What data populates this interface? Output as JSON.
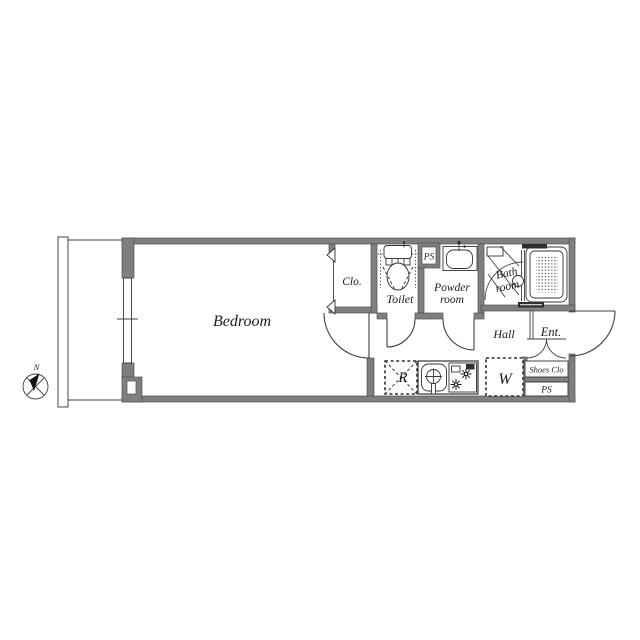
{
  "document": {
    "type": "apartment-floor-plan"
  },
  "colors": {
    "wall": "#7f7f7f",
    "line": "#3f3f3f",
    "text": "#1c1c1c",
    "background": "#ffffff"
  },
  "compass": {
    "north_label": "N"
  },
  "rooms": {
    "bedroom": {
      "label": "Bedroom"
    },
    "closet": {
      "label": "Clo."
    },
    "toilet": {
      "label": "Toilet"
    },
    "ps_top": {
      "label": "PS"
    },
    "powder": {
      "line1": "Powder",
      "line2": "room"
    },
    "bath": {
      "line1": "Bath",
      "line2": "room"
    },
    "hall": {
      "label": "Hall"
    },
    "entrance": {
      "label": "Ent."
    },
    "refrigerator": {
      "label": "R"
    },
    "washer": {
      "label": "W"
    },
    "shoes_closet": {
      "label": "Shoes Clo"
    },
    "ps_bottom": {
      "label": "PS"
    }
  },
  "icons": {
    "compass-icon": "circle with crossed spokes and black north needle",
    "toilet-icon": "tank + seat + bowl ellipse with dashed clearance",
    "sink-icon": "rounded basin with faucet dot",
    "bathtub-icon": "rounded tub with dotted mat",
    "kitchen-sink-icon": "round sink with cross faucet",
    "stove-icon": "two asterisk burners with grill",
    "door-arc-icon": "quarter-circle swing arcs"
  }
}
